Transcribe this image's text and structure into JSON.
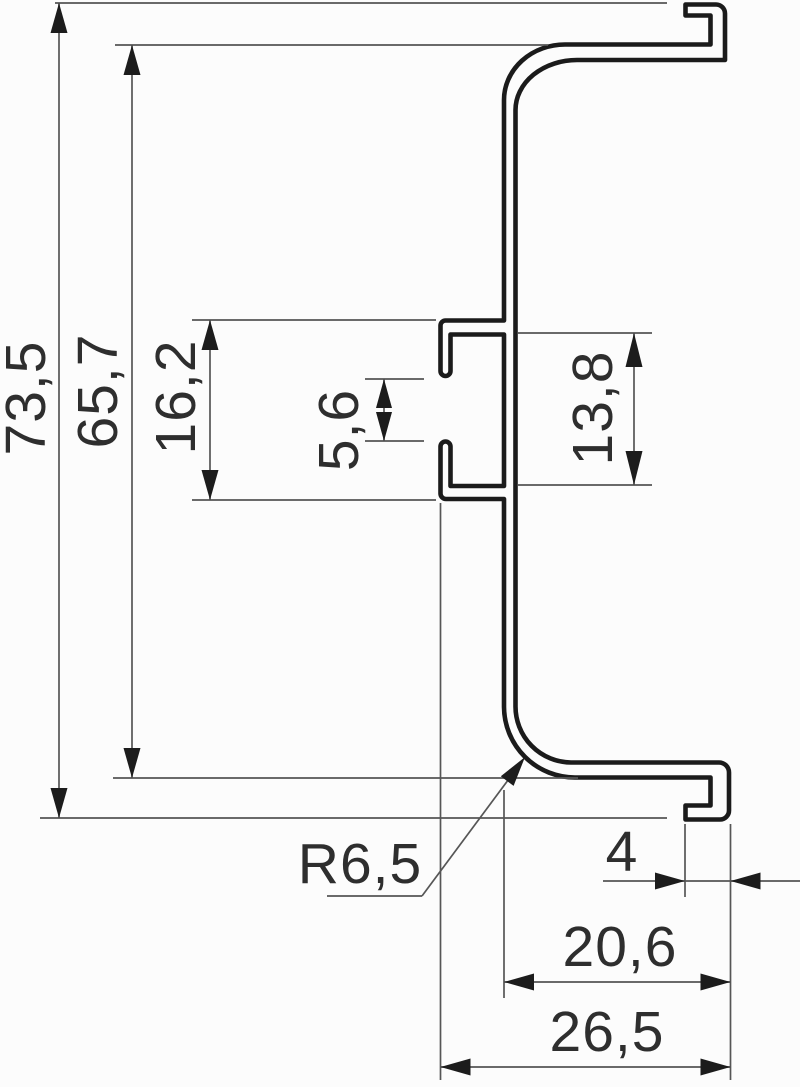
{
  "drawing": {
    "kind": "profile-cross-section-dimension-drawing",
    "units": "mm"
  },
  "labels": {
    "overall_height": "73,5",
    "inner_height": "65,7",
    "clip_outer_height": "16,2",
    "clip_gap": "5,6",
    "clip_inner_height": "13,8",
    "bend_radius": "R6,5",
    "hook_depth": "4",
    "depth_to_web": "20,6",
    "overall_depth": "26,5"
  },
  "colors": {
    "background": "#fcfcfc",
    "profile_stroke": "#1b1b1b",
    "dimension_stroke": "#565656",
    "label_text": "#2e2e2e"
  }
}
